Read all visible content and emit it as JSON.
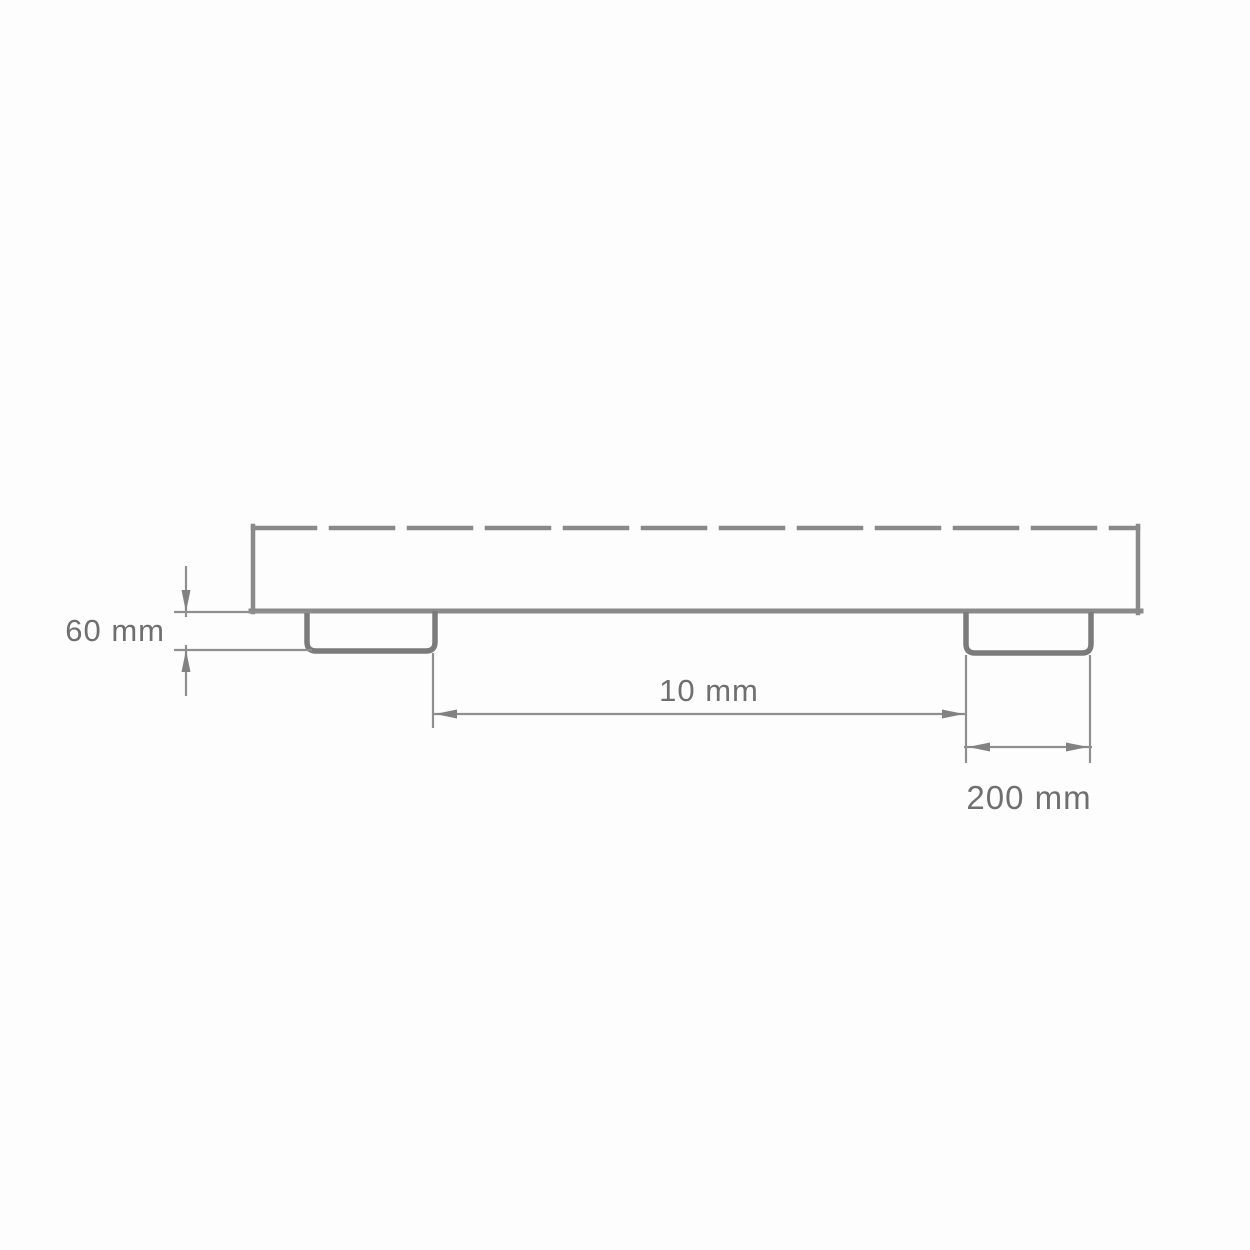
{
  "page": {
    "background": "#fdfdfd"
  },
  "diagram": {
    "type": "technical-drawing",
    "description": "Side cross-section of a flat panel with a dashed top edge and two support feet, annotated with three dimensions",
    "labels": {
      "height": "60 mm",
      "gap": "10 mm",
      "foot_width": "200 mm"
    },
    "colors": {
      "body_line": "#8a8a8a",
      "foot_line": "#7b7b7b",
      "dimension_line": "#8f8f8f",
      "arrow_fill": "#828282",
      "text": "#6f6f6f",
      "background": "#fdfdfd"
    }
  }
}
